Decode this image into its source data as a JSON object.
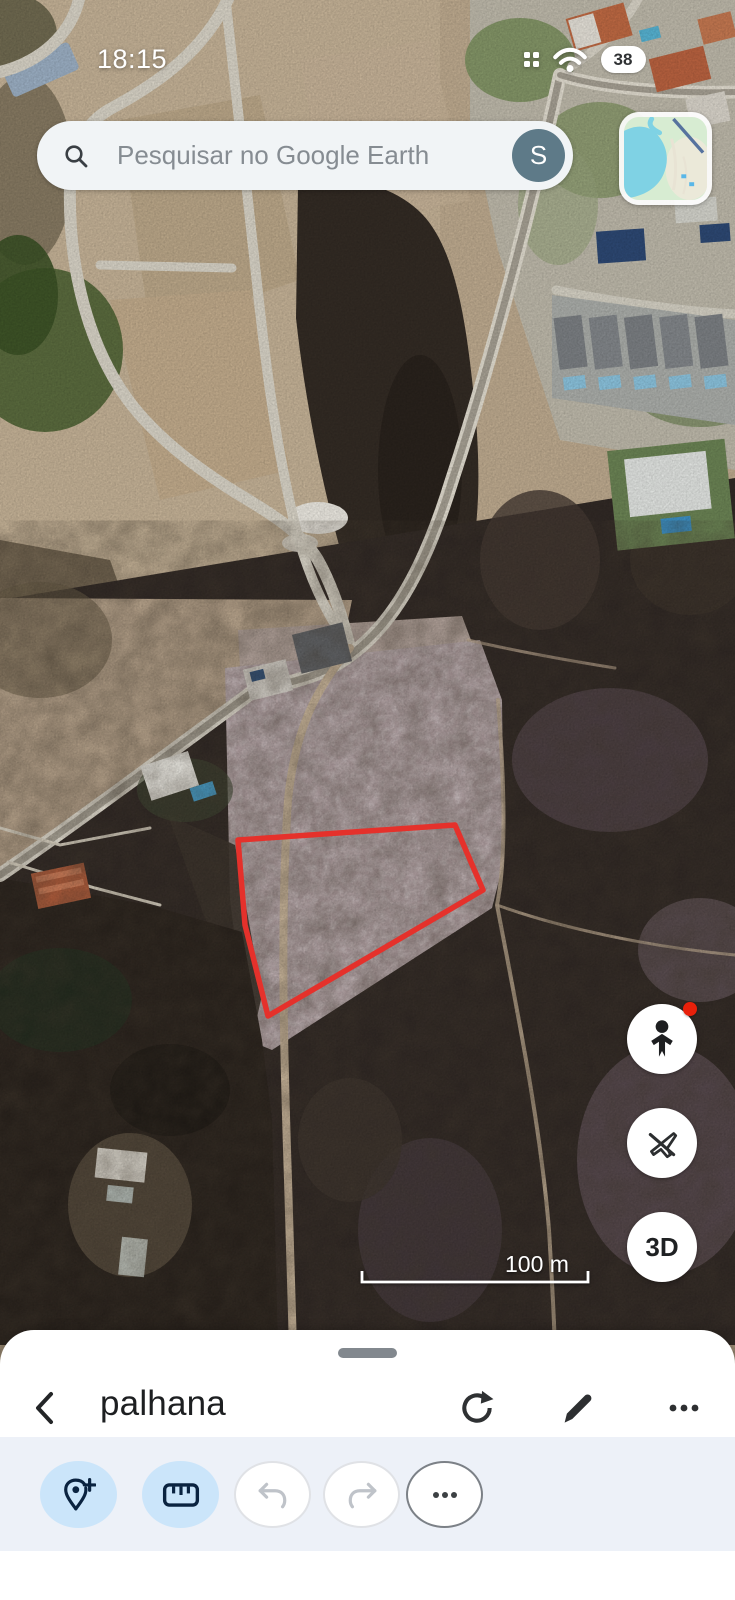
{
  "app_title": "Google Earth",
  "status_bar": {
    "time": "18:15",
    "battery_percent": "38",
    "icons": [
      "grid-icon",
      "wifi-icon",
      "battery-icon"
    ]
  },
  "search": {
    "placeholder": "Pesquisar no Google Earth",
    "icon": "search-icon",
    "avatar_initial": "S"
  },
  "map_thumbnail": {
    "description": "map layers thumbnail"
  },
  "map_controls": {
    "pegman": {
      "icon": "pegman-icon",
      "has_notification_dot": true
    },
    "flight": {
      "icon": "flight-off-icon"
    },
    "threed": {
      "label": "3D"
    }
  },
  "scale_bar": {
    "label": "100 m"
  },
  "parcel_outline": {
    "color": "#e5312b",
    "points": "238,840 455,825 483,890 268,1016 245,925"
  },
  "bottom_sheet": {
    "title": "palhana",
    "header_icons": [
      "back-chevron-icon",
      "refresh-icon",
      "pencil-icon",
      "overflow-menu-icon"
    ],
    "toolbar": {
      "buttons": [
        {
          "name": "add-placemark",
          "icon": "pin-plus-icon",
          "enabled": true
        },
        {
          "name": "measure",
          "icon": "ruler-icon",
          "enabled": true
        },
        {
          "name": "undo",
          "icon": "undo-icon",
          "enabled": false
        },
        {
          "name": "redo",
          "icon": "redo-icon",
          "enabled": false
        },
        {
          "name": "more-tools",
          "icon": "ellipsis-icon",
          "enabled": true
        }
      ]
    }
  },
  "colors": {
    "parcel_red": "#e5312b",
    "toolbar_bg": "#edf1f8",
    "active_tool_blue": "#cbe5fa",
    "tool_icon_navy": "#0a2340",
    "avatar_slate": "#5e7a88",
    "notification_red": "#e8200a"
  }
}
